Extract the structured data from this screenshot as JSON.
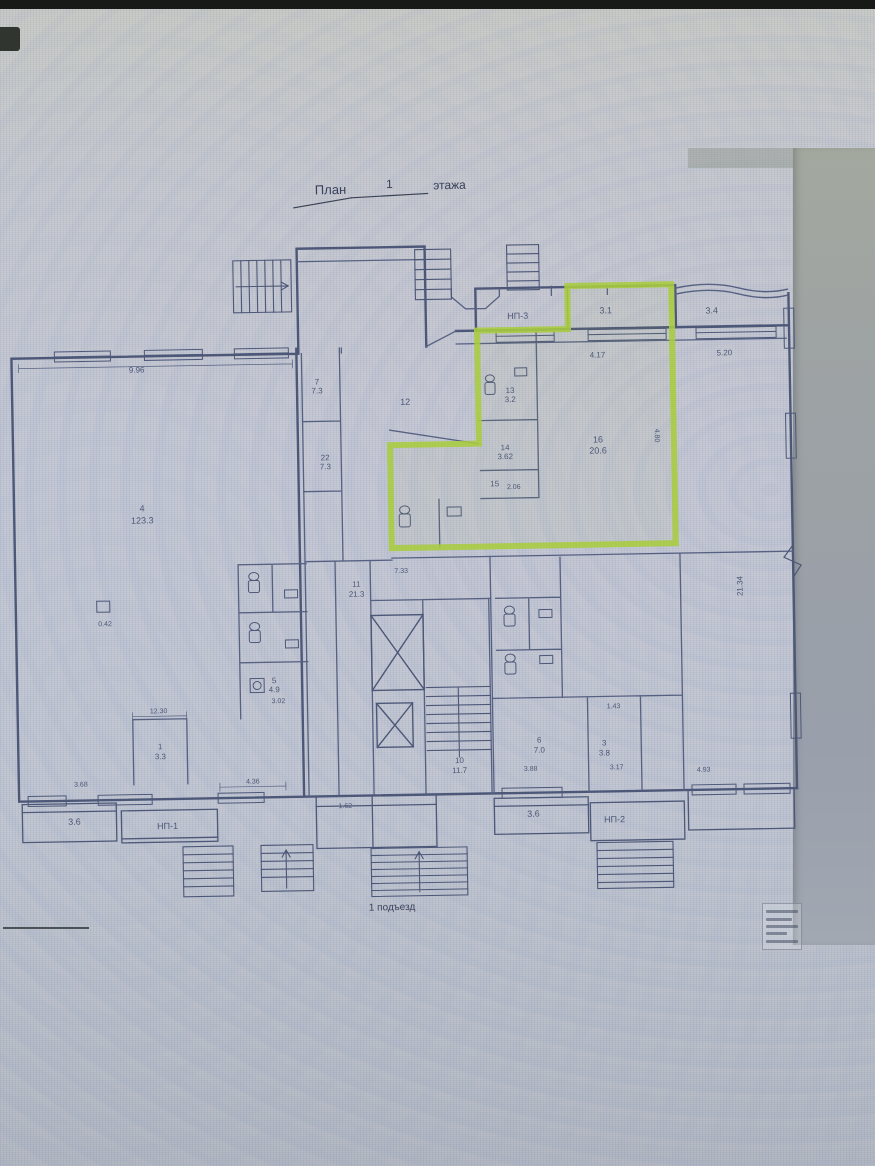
{
  "document": {
    "type_note": "scanned floor plan photographed on a monitor",
    "title_full": "План 1 этажа",
    "caption": "1 подъезд"
  },
  "colors": {
    "ink": "#4d5878",
    "ink_dark": "#39415c",
    "highlight_green": "#a8cc3f",
    "screen_bg": "#bfc5cf",
    "bezel": "#171a17"
  },
  "highlight": {
    "meaning": "green outlined unit in upper-right of plan",
    "rooms_inside": [
      "3.1",
      "13 / 3.2",
      "14 / 3.62",
      "15 / 2.06",
      "16 / 20.6"
    ]
  },
  "plan": {
    "labels": [
      {
        "t": "План",
        "x": 337,
        "y": 193,
        "s": 13,
        "d": true
      },
      {
        "t": "1",
        "x": 396,
        "y": 188,
        "s": 12,
        "d": true
      },
      {
        "t": "этажа",
        "x": 456,
        "y": 190,
        "s": 12,
        "d": true
      },
      {
        "t": "НП-3",
        "x": 522,
        "y": 321,
        "s": 9
      },
      {
        "t": "3.1",
        "x": 610,
        "y": 317,
        "s": 9
      },
      {
        "t": "3.4",
        "x": 716,
        "y": 319,
        "s": 9
      },
      {
        "t": "4.17",
        "x": 601,
        "y": 361,
        "s": 8
      },
      {
        "t": "5.20",
        "x": 728,
        "y": 361,
        "s": 8
      },
      {
        "t": "9.96",
        "x": 140,
        "y": 368,
        "s": 8
      },
      {
        "t": "13",
        "x": 513,
        "y": 395,
        "s": 8
      },
      {
        "t": "3.2",
        "x": 513,
        "y": 404,
        "s": 8
      },
      {
        "t": "12",
        "x": 408,
        "y": 405,
        "s": 9
      },
      {
        "t": "7",
        "x": 320,
        "y": 383,
        "s": 8
      },
      {
        "t": "7.3",
        "x": 320,
        "y": 392,
        "s": 8
      },
      {
        "t": "22",
        "x": 327,
        "y": 459,
        "s": 8
      },
      {
        "t": "7.3",
        "x": 327,
        "y": 468,
        "s": 8
      },
      {
        "t": "14",
        "x": 507,
        "y": 452,
        "s": 8
      },
      {
        "t": "3.62",
        "x": 507,
        "y": 461,
        "s": 8
      },
      {
        "t": "15",
        "x": 496,
        "y": 488,
        "s": 8
      },
      {
        "t": "2.06",
        "x": 515,
        "y": 491,
        "s": 7
      },
      {
        "t": "16",
        "x": 600,
        "y": 446,
        "s": 9
      },
      {
        "t": "20.6",
        "x": 600,
        "y": 457,
        "s": 9
      },
      {
        "t": "4.80",
        "x": 657,
        "y": 440,
        "s": 7,
        "r": 90
      },
      {
        "t": "4",
        "x": 143,
        "y": 507,
        "s": 9
      },
      {
        "t": "123.3",
        "x": 143,
        "y": 519,
        "s": 9
      },
      {
        "t": "0.42",
        "x": 104,
        "y": 621,
        "s": 7
      },
      {
        "t": "11",
        "x": 356,
        "y": 586,
        "s": 8
      },
      {
        "t": "21.3",
        "x": 356,
        "y": 596,
        "s": 8
      },
      {
        "t": "7.33",
        "x": 401,
        "y": 573,
        "s": 7
      },
      {
        "t": "5",
        "x": 272,
        "y": 681,
        "s": 8
      },
      {
        "t": "4.9",
        "x": 272,
        "y": 690,
        "s": 8
      },
      {
        "t": "3.02",
        "x": 276,
        "y": 701,
        "s": 7
      },
      {
        "t": "10",
        "x": 456,
        "y": 764,
        "s": 8
      },
      {
        "t": "11.7",
        "x": 456,
        "y": 774,
        "s": 8
      },
      {
        "t": "6",
        "x": 536,
        "y": 745,
        "s": 8
      },
      {
        "t": "7.0",
        "x": 536,
        "y": 755,
        "s": 8
      },
      {
        "t": "3",
        "x": 601,
        "y": 749,
        "s": 8
      },
      {
        "t": "3.8",
        "x": 601,
        "y": 759,
        "s": 8
      },
      {
        "t": "1.43",
        "x": 611,
        "y": 712,
        "s": 7
      },
      {
        "t": "3.88",
        "x": 527,
        "y": 773,
        "s": 7
      },
      {
        "t": "3.17",
        "x": 613,
        "y": 773,
        "s": 7
      },
      {
        "t": "4.93",
        "x": 700,
        "y": 777,
        "s": 7
      },
      {
        "t": "21.34",
        "x": 742,
        "y": 592,
        "s": 8,
        "r": -90
      },
      {
        "t": "12.30",
        "x": 156,
        "y": 709,
        "s": 7
      },
      {
        "t": "1",
        "x": 157,
        "y": 745,
        "s": 8
      },
      {
        "t": "3.3",
        "x": 157,
        "y": 755,
        "s": 8
      },
      {
        "t": "3.68",
        "x": 77,
        "y": 781,
        "s": 7
      },
      {
        "t": "4.36",
        "x": 249,
        "y": 781,
        "s": 7
      },
      {
        "t": "1.62",
        "x": 341,
        "y": 807,
        "s": 7
      },
      {
        "t": "3.6",
        "x": 70,
        "y": 819,
        "s": 9
      },
      {
        "t": "НП-1",
        "x": 163,
        "y": 825,
        "s": 9
      },
      {
        "t": "3.6",
        "x": 529,
        "y": 819,
        "s": 9
      },
      {
        "t": "НП-2",
        "x": 610,
        "y": 826,
        "s": 9
      },
      {
        "t": "1 подъезд",
        "x": 386,
        "y": 910,
        "s": 10,
        "d": true
      }
    ]
  }
}
